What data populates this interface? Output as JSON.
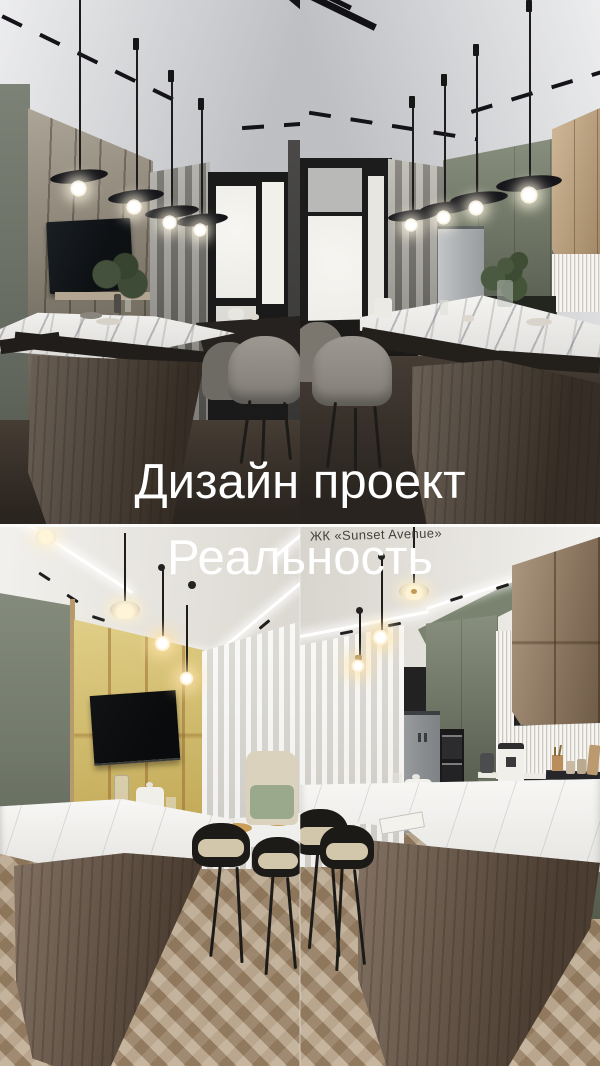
{
  "overlay": {
    "title_top": "Дизайн проект",
    "title_bottom": "Реальность",
    "caption": "ЖК «Sunset Avenue»"
  },
  "colors": {
    "title": "#ffffff",
    "caption": "#45443b",
    "seam": "#fbfbfa",
    "ceiling_render": "#d6d7da",
    "ceiling_real": "#eae7e1",
    "wall_sage": "#79806f",
    "wall_beige": "#998f7d",
    "wall_yellow": "#d8c266",
    "cabinet_green": "#747c68",
    "cabinet_wood": "#997e61",
    "cabinet_wood_render": "#c4a57c",
    "marble": "#f1f0ec",
    "island_wood": "#6b5746",
    "island_wood_render": "#4e4236",
    "floor_dark": "#38312b",
    "floor_oak": "#b0997c",
    "curtain_gray": "#94928a",
    "curtain_sheer": "#e9e7e1",
    "fixture_black": "#1a1918",
    "chair_gray": "#938f88",
    "cushion": "#d2c6ab",
    "fridge_steel": "#aaadaf",
    "tile": "#ece9e3"
  }
}
